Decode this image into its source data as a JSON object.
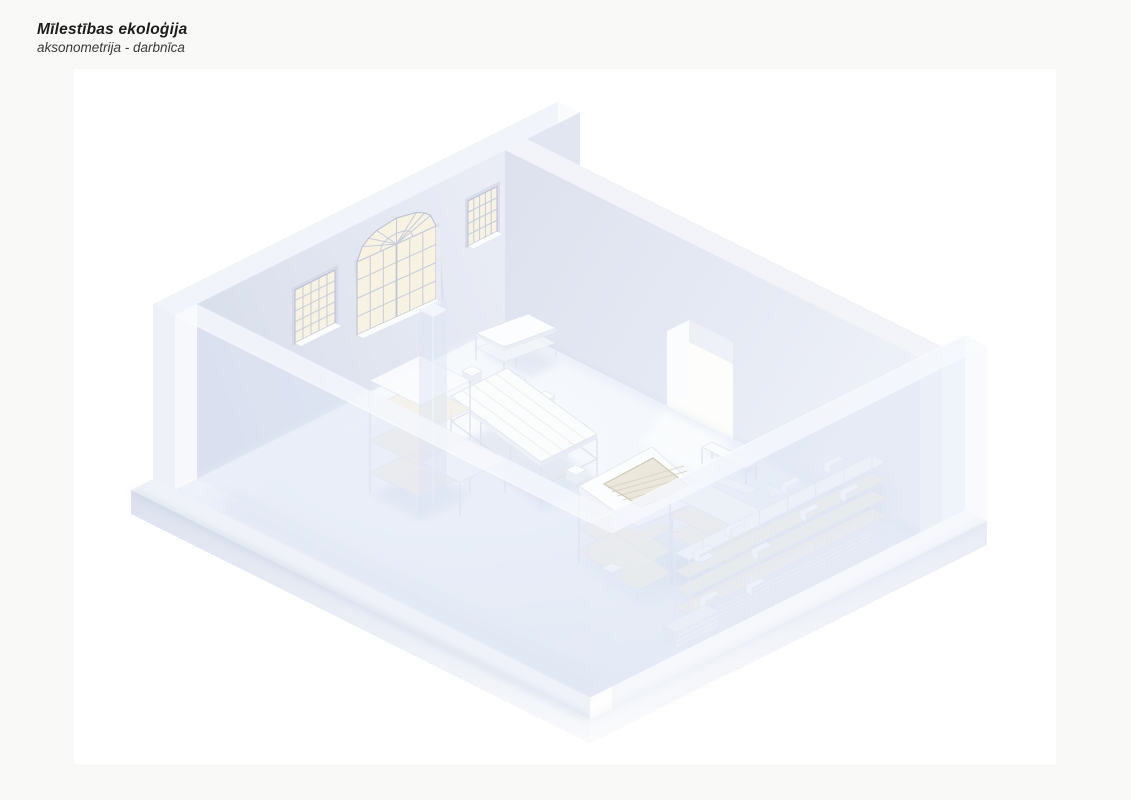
{
  "page": {
    "background": "#f9faf7",
    "canvas_background": "#ffffff"
  },
  "header": {
    "title": "Mīlestības ekoloģija",
    "subtitle": "aksonometrija - darbnīca"
  },
  "drawing": {
    "kind": "axonometric cutaway rendering of a workshop interior",
    "room_label": "darbnīca",
    "elements": [
      {
        "name": "back-left-wall",
        "desc": "wall with two small grid windows and a large arched fan window"
      },
      {
        "name": "back-right-wall",
        "desc": "wall with open doorway near its right end"
      },
      {
        "name": "front-ghost-walls",
        "desc": "translucent cut-away front walls"
      },
      {
        "name": "floor-slab",
        "desc": "floor plate on a plinth"
      },
      {
        "name": "console-table",
        "desc": "small open-frame table against the back wall"
      },
      {
        "name": "long-work-table",
        "desc": "long work table surrounded by stools"
      },
      {
        "name": "corner-shelving",
        "desc": "open shelving unit with attached side table"
      },
      {
        "name": "pit-work-table",
        "desc": "square rimmed pit table on a shelf scaffold"
      },
      {
        "name": "side-shelving",
        "desc": "small open rack beside the pit table"
      },
      {
        "name": "work-bench",
        "desc": "bench and loose boards by the doorway"
      },
      {
        "name": "material-rack",
        "desc": "long storage rack along the translucent front wall"
      },
      {
        "name": "structural-column",
        "desc": "translucent cut structural column"
      }
    ],
    "palette": {
      "wall": "#dfe3ef",
      "wall_top": "#f1f4fa",
      "wall_end": "#fafbfd",
      "floor": "#eef2f9",
      "floor_highlight": "#f9fbfe",
      "window_pane": "#f7f2e1",
      "window_muntin": "#c6ccdd",
      "ghost_wall": "rgba(221,229,245,0.35)",
      "wood": "#ece8da",
      "furniture": "#fbfcfe",
      "shadow": "#cfd7e7"
    }
  }
}
